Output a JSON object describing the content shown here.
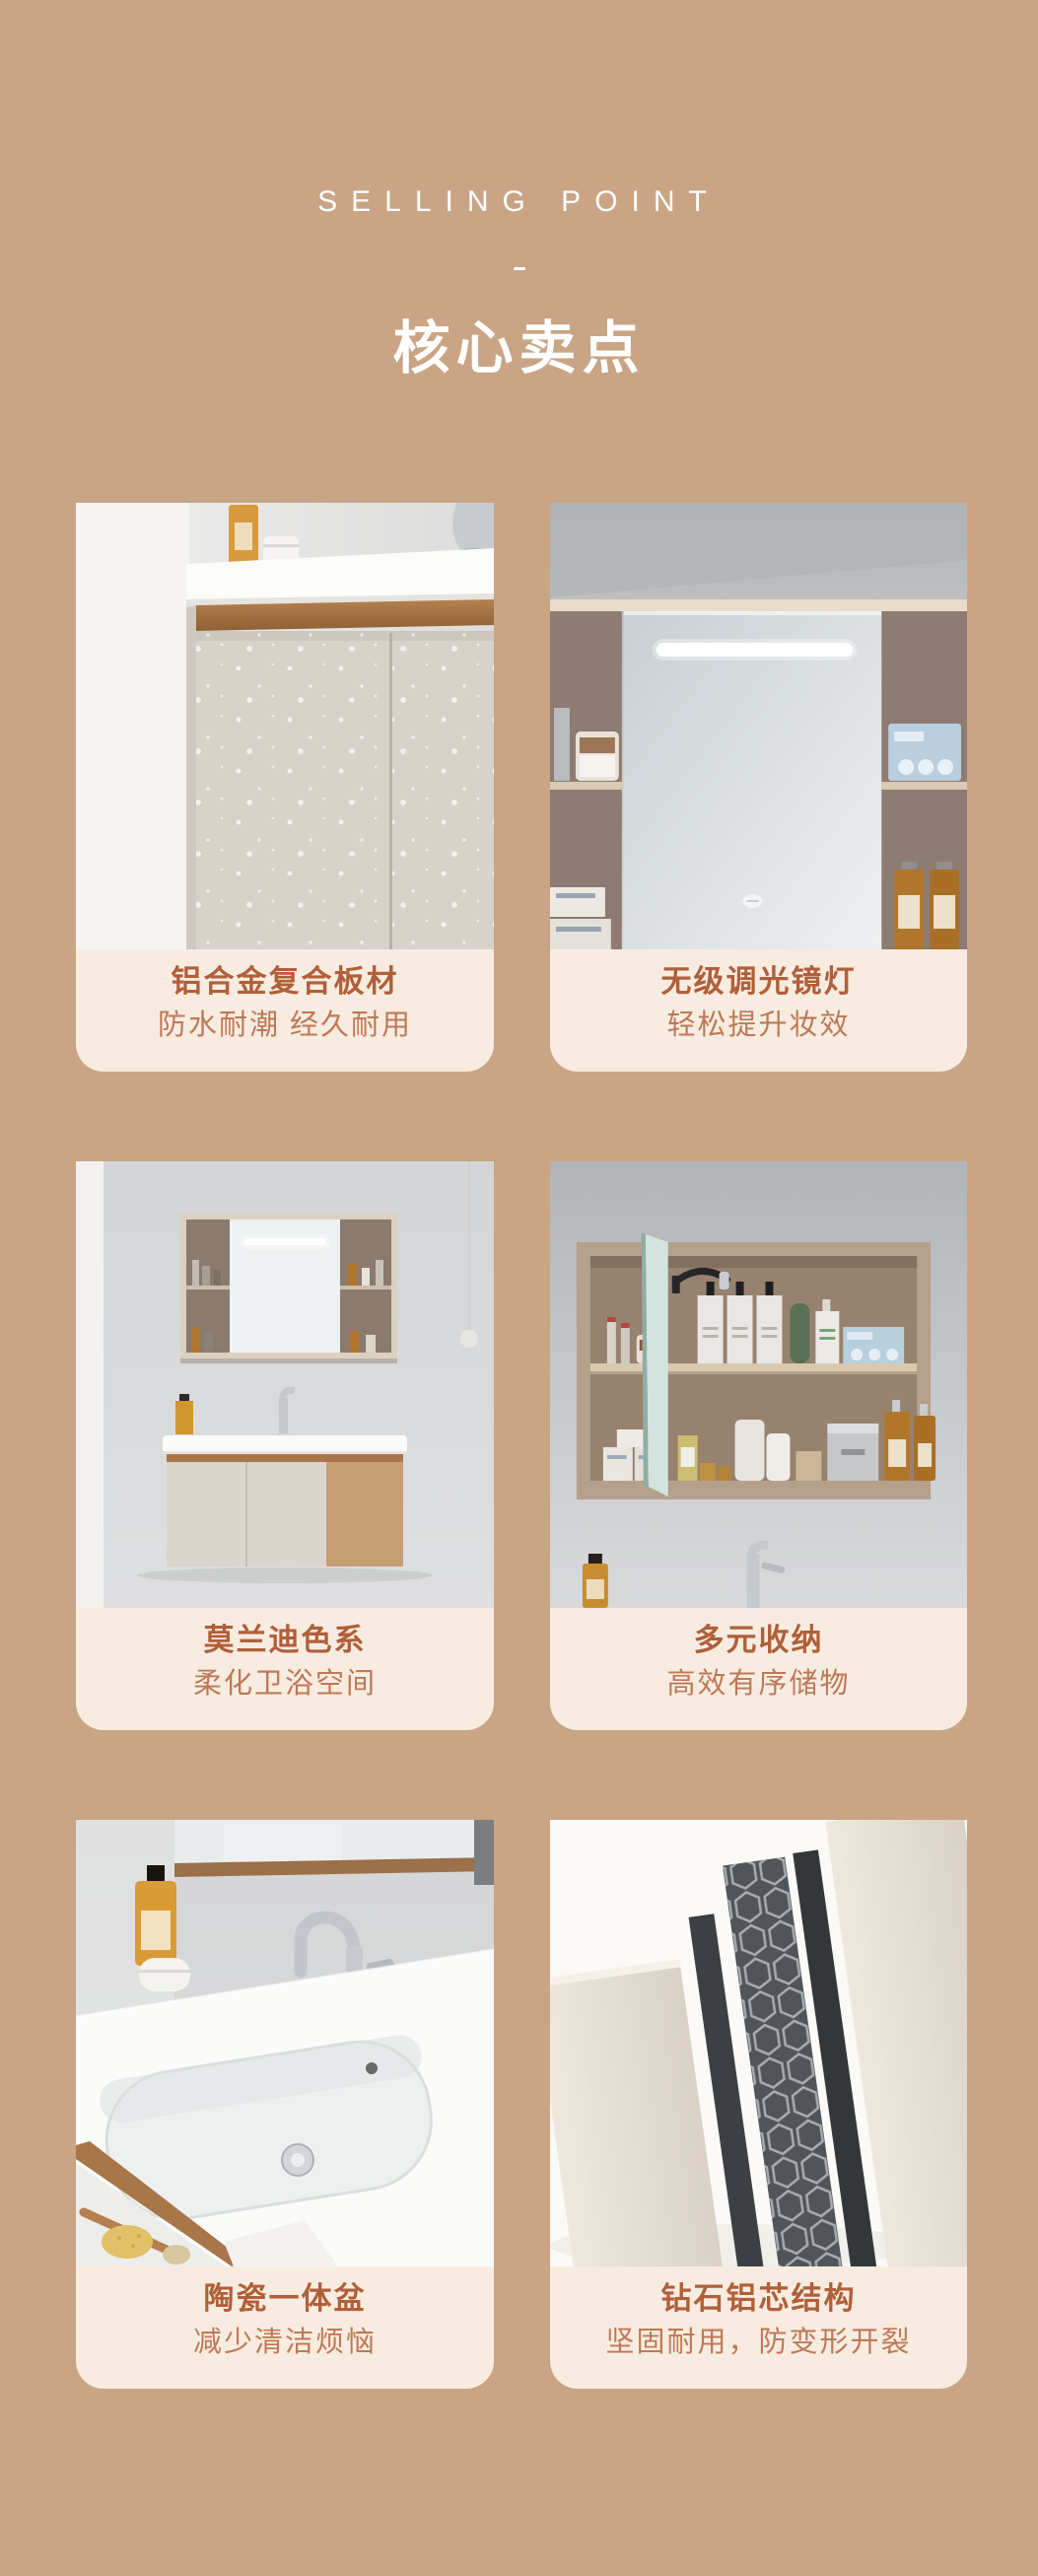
{
  "header": {
    "eyebrow": "SELLING POINT",
    "divider": "-",
    "title": "核心卖点"
  },
  "colors": {
    "page_background": "#c9a585",
    "caption_background": "#f7ecdf",
    "card_title_text": "#b05f3a",
    "card_subtitle_text": "#be7858",
    "header_text": "#ffffff"
  },
  "cards": [
    {
      "title": "铝合金复合板材",
      "subtitle": "防水耐潮 经久耐用"
    },
    {
      "title": "无级调光镜灯",
      "subtitle": "轻松提升妆效"
    },
    {
      "title": "莫兰迪色系",
      "subtitle": "柔化卫浴空间"
    },
    {
      "title": "多元收纳",
      "subtitle": "高效有序储物"
    },
    {
      "title": "陶瓷一体盆",
      "subtitle": "减少清洁烦恼"
    },
    {
      "title": "钻石铝芯结构",
      "subtitle": "坚固耐用，防变形开裂"
    }
  ]
}
